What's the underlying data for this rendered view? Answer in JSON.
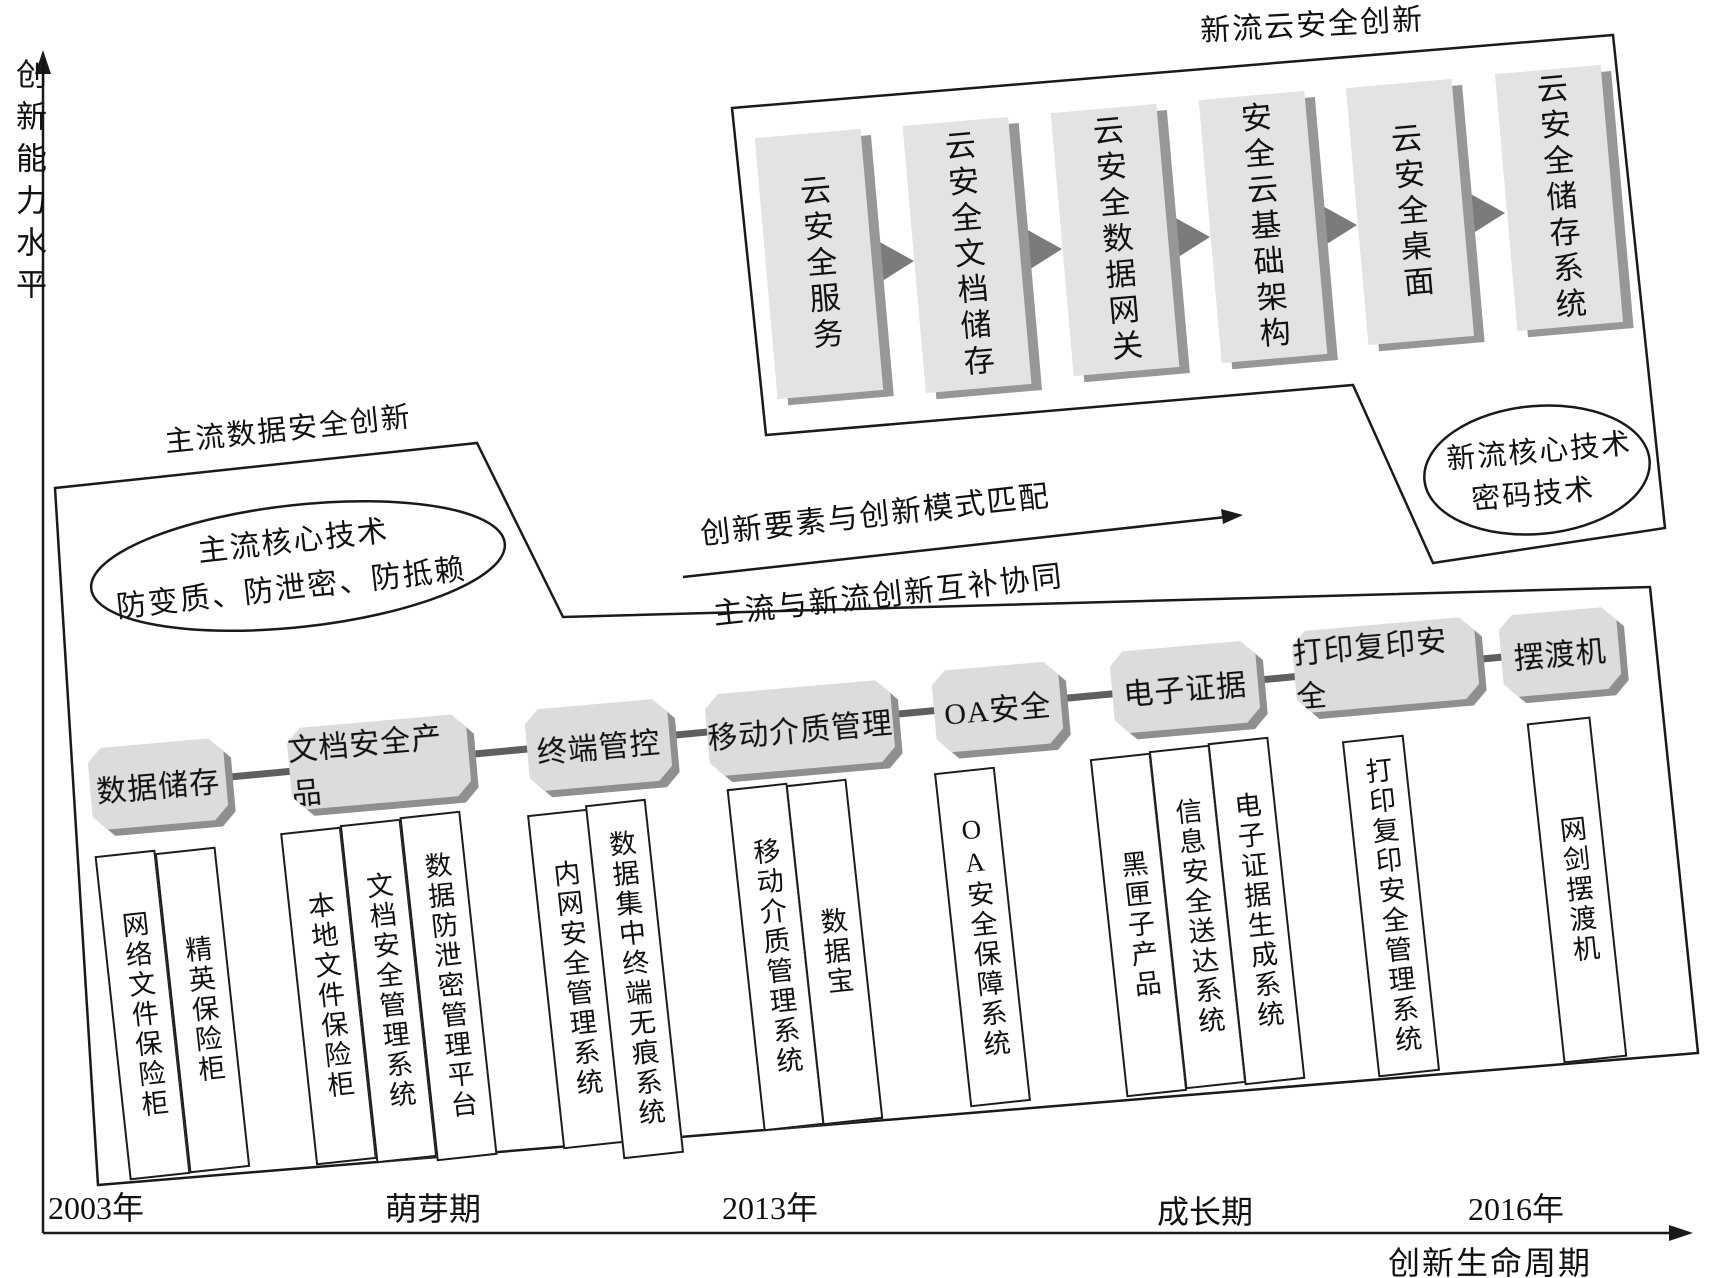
{
  "axes": {
    "y_label": "创新能力水平",
    "x_label": "创新生命周期",
    "ticks": [
      "2003年",
      "萌芽期",
      "2013年",
      "成长期",
      "2016年"
    ]
  },
  "newstream": {
    "title": "新流云安全创新",
    "boxes": [
      "云安全服务",
      "云安全文档储存",
      "云安全数据网关",
      "安全云基础架构",
      "云安全桌面",
      "云安全储存系统"
    ],
    "ellipse": {
      "line1": "新流核心技术",
      "line2": "密码技术"
    }
  },
  "mainstream": {
    "title": "主流数据安全创新",
    "ellipse": {
      "line1": "主流核心技术",
      "line2": "防变质、防泄密、防抵赖"
    }
  },
  "middle": {
    "above_arrow": "创新要素与创新模式匹配",
    "below_arrow": "主流与新流创新互补协同"
  },
  "timeline": {
    "categories": [
      {
        "label": "数据储存",
        "products": [
          "网络文件保险柜",
          "精英保险柜"
        ]
      },
      {
        "label": "文档安全产品",
        "products": [
          "本地文件保险柜",
          "文档安全管理系统",
          "数据防泄密管理平台"
        ]
      },
      {
        "label": "终端管控",
        "products": [
          "内网安全管理系统",
          "数据集中终端无痕系统"
        ]
      },
      {
        "label": "移动介质管理",
        "products": [
          "移动介质管理系统",
          "数据宝"
        ]
      },
      {
        "label": "OA安全",
        "products": [
          "OA安全保障系统"
        ]
      },
      {
        "label": "电子证据",
        "products": [
          "黑匣子产品",
          "信息安全送达系统",
          "电子证据生成系统"
        ]
      },
      {
        "label": "打印复印安全",
        "products": [
          "打印复印安全管理系统"
        ]
      },
      {
        "label": "摆渡机",
        "products": [
          "网剑摆渡机"
        ]
      }
    ]
  },
  "colors": {
    "outline": "#1a1a1a",
    "category_fill": "#dcdcdc",
    "cloud_fill": "#e3e3e3",
    "shadow": "#8f8f8f",
    "trend_line": "#5f5f5f",
    "flow_arrow": "#7b7b7b",
    "background": "#ffffff"
  }
}
